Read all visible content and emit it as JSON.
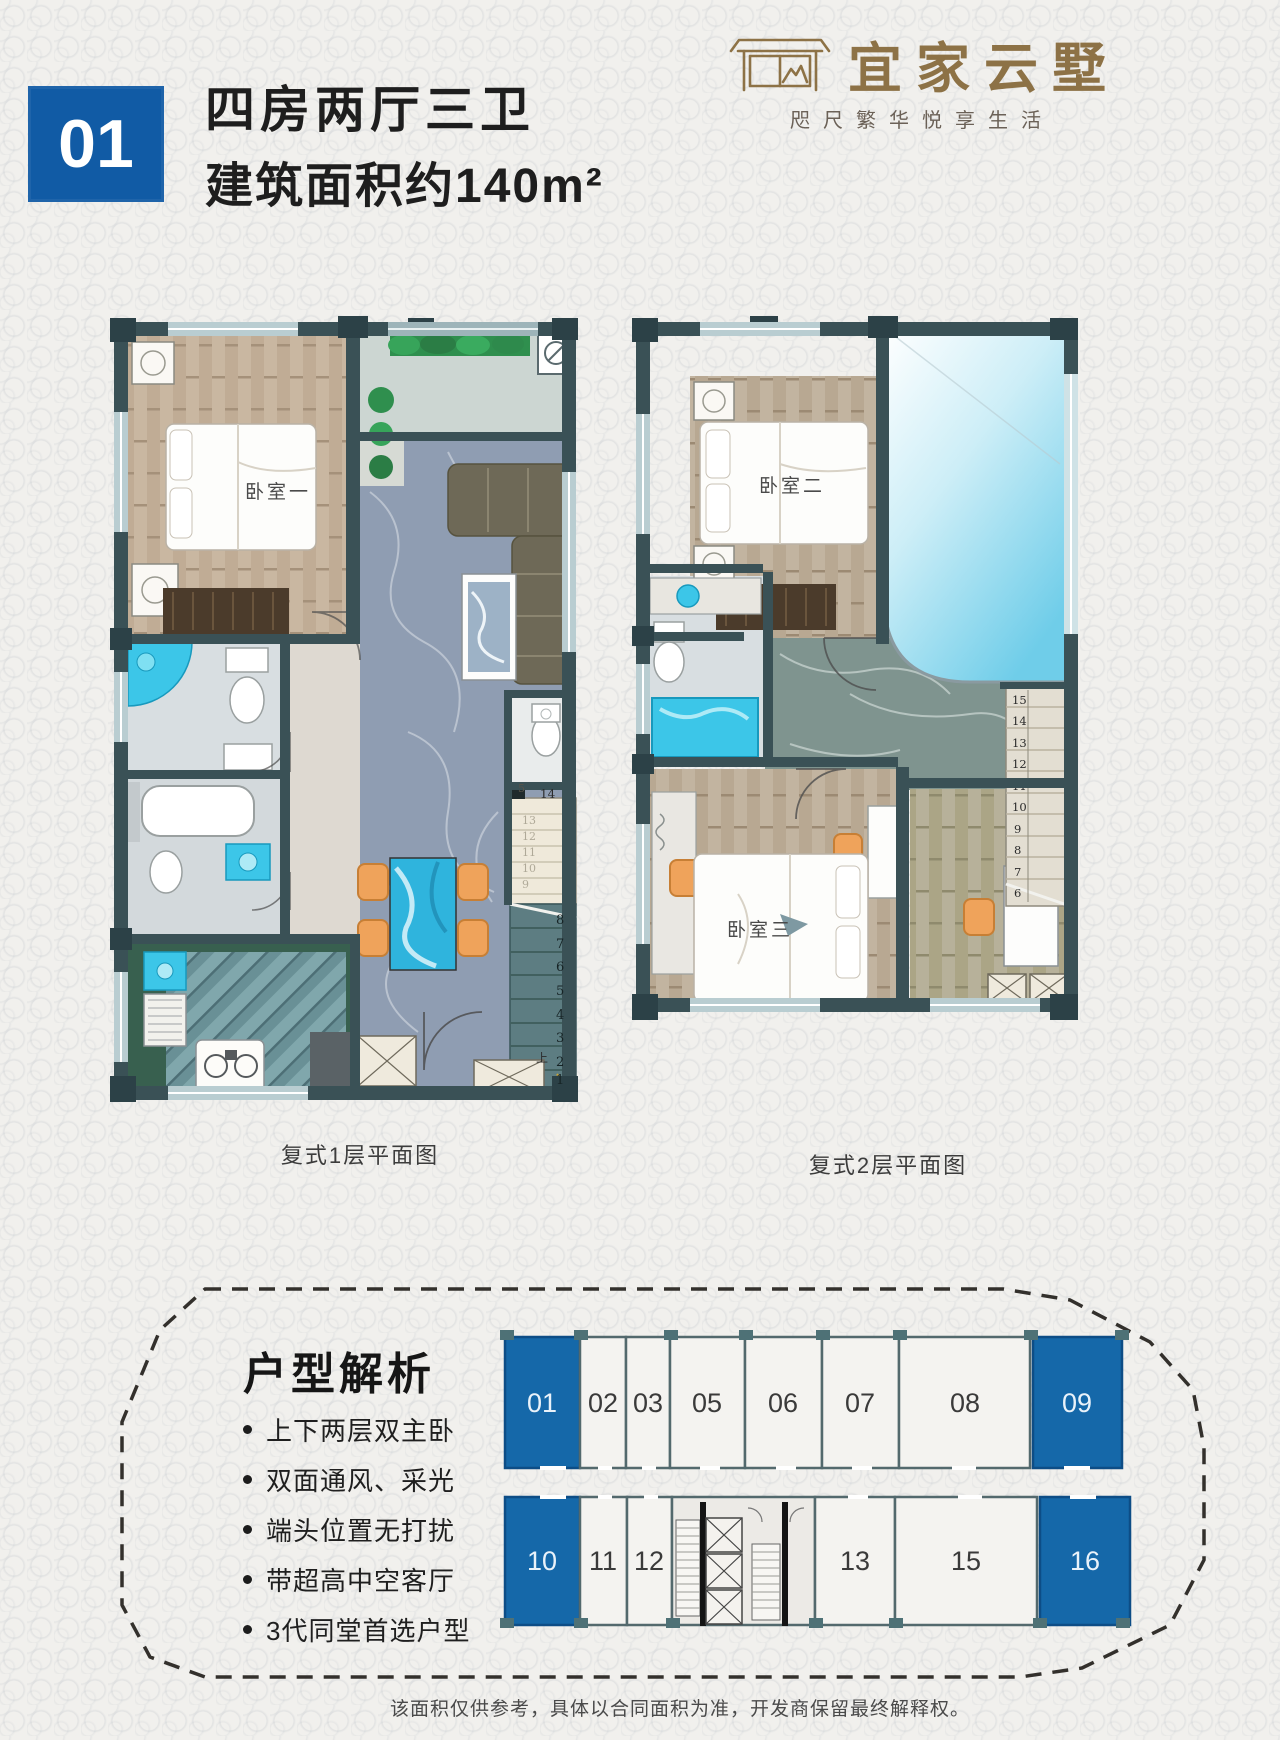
{
  "colors": {
    "primary_blue": "#115BA5",
    "highlight_unit_blue": "#1568A9",
    "brand_gold": "#8D7246",
    "wall_dark": "#3A5156",
    "fixture_cyan": "#3CC6E8",
    "chair_orange": "#EFA35B",
    "wood_floor": "#C7B49E",
    "marble_floor": "#8F9DB2"
  },
  "header": {
    "badge": "01",
    "title_line1": "四房两厅三卫",
    "title_line2": "建筑面积约140m²",
    "brand_name": "宜家云墅",
    "brand_tagline": "咫尺繁华悦享生活"
  },
  "plan1": {
    "caption": "复式1层平面图",
    "bedroom1_label": "卧室一",
    "stair_top_label": "14",
    "stair_mid_label": "5",
    "up_label": "上",
    "upper_steps": [
      "13",
      "12",
      "11",
      "10",
      "9"
    ],
    "lower_steps": [
      "8",
      "7",
      "6",
      "5",
      "4",
      "3",
      "2",
      "1"
    ]
  },
  "plan2": {
    "caption": "复式2层平面图",
    "bedroom2_label": "卧室二",
    "bedroom3_label": "卧室三",
    "steps": [
      "15",
      "14",
      "13",
      "12",
      "11",
      "10",
      "9",
      "8",
      "7",
      "6"
    ]
  },
  "analysis": {
    "heading": "户型解析",
    "bullets": [
      "上下两层双主卧",
      "双面通风、采光",
      "端头位置无打扰",
      "带超高中空客厅",
      "3代同堂首选户型"
    ]
  },
  "keyplan": {
    "top_row": [
      {
        "label": "01",
        "highlighted": true
      },
      {
        "label": "02",
        "highlighted": false
      },
      {
        "label": "03",
        "highlighted": false
      },
      {
        "label": "05",
        "highlighted": false
      },
      {
        "label": "06",
        "highlighted": false
      },
      {
        "label": "07",
        "highlighted": false
      },
      {
        "label": "08",
        "highlighted": false
      },
      {
        "label": "09",
        "highlighted": true
      }
    ],
    "bottom_row": [
      {
        "label": "10",
        "highlighted": true
      },
      {
        "label": "11",
        "highlighted": false
      },
      {
        "label": "12",
        "highlighted": false
      },
      {
        "label": "13",
        "highlighted": false
      },
      {
        "label": "15",
        "highlighted": false
      },
      {
        "label": "16",
        "highlighted": true
      }
    ]
  },
  "footer": {
    "disclaimer": "该面积仅供参考，具体以合同面积为准，开发商保留最终解释权。"
  }
}
